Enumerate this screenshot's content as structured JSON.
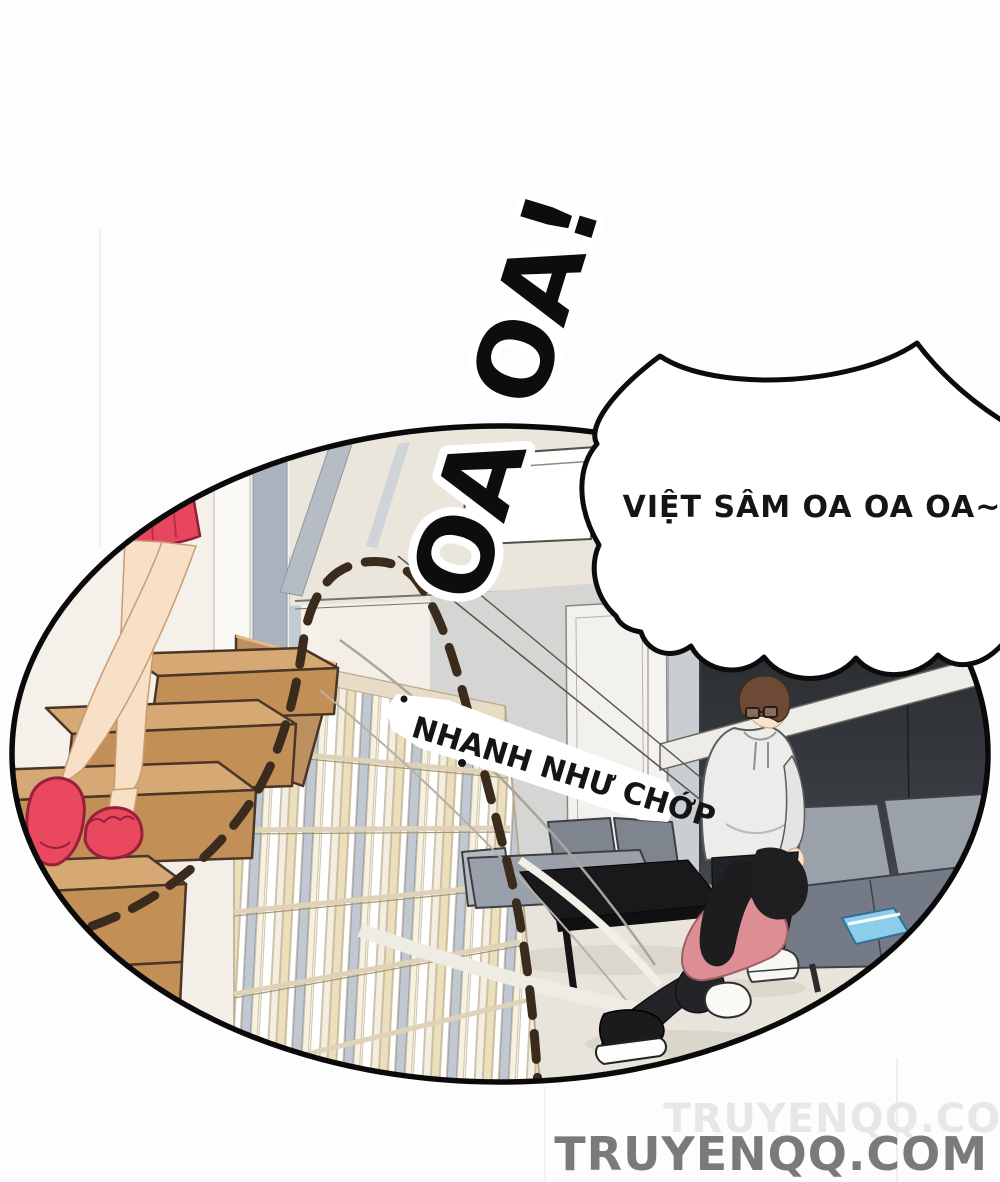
{
  "page": {
    "type": "comic-page",
    "background": "#fdfdfd"
  },
  "sfx": {
    "scream": {
      "text": "OA OA!",
      "color": "#0d0d0d",
      "outline": "#ffffff"
    },
    "flash": {
      "text": "NHANH NHƯ CHỚP",
      "color": "#151515",
      "background": "#ffffff"
    }
  },
  "speech_bubble": {
    "text": "VIỆT SÂM OA OA OA~",
    "fill": "#ffffff",
    "stroke": "#0c0c0c",
    "text_color": "#151515"
  },
  "watermark": {
    "text": "TRUYENQQ.COM",
    "color": "#7a7a7a",
    "ghost_color": "#e7e7e5"
  },
  "panel": {
    "shape": "ellipse",
    "border_color": "#0a0a0a",
    "palette": {
      "stairs_top": "#d6a873",
      "stairs_front": "#c29057",
      "slippers": "#e9485f",
      "skirt": "#e8465f",
      "skin": "#f7e0c5",
      "bookshelf_frame": "#dfd2b8",
      "sofa": "#9aa1ab",
      "coffee_table": "#19191b",
      "dark_wall": "#26292d",
      "girl_sweater": "#dd8e95",
      "man_hoodie": "#ececea",
      "hair_brown": "#6d4a35",
      "hair_black": "#1d1c1f",
      "book_blue": "#8ccdec",
      "dash_line": "#3b2b1d",
      "floor": "#e8e4db"
    }
  }
}
